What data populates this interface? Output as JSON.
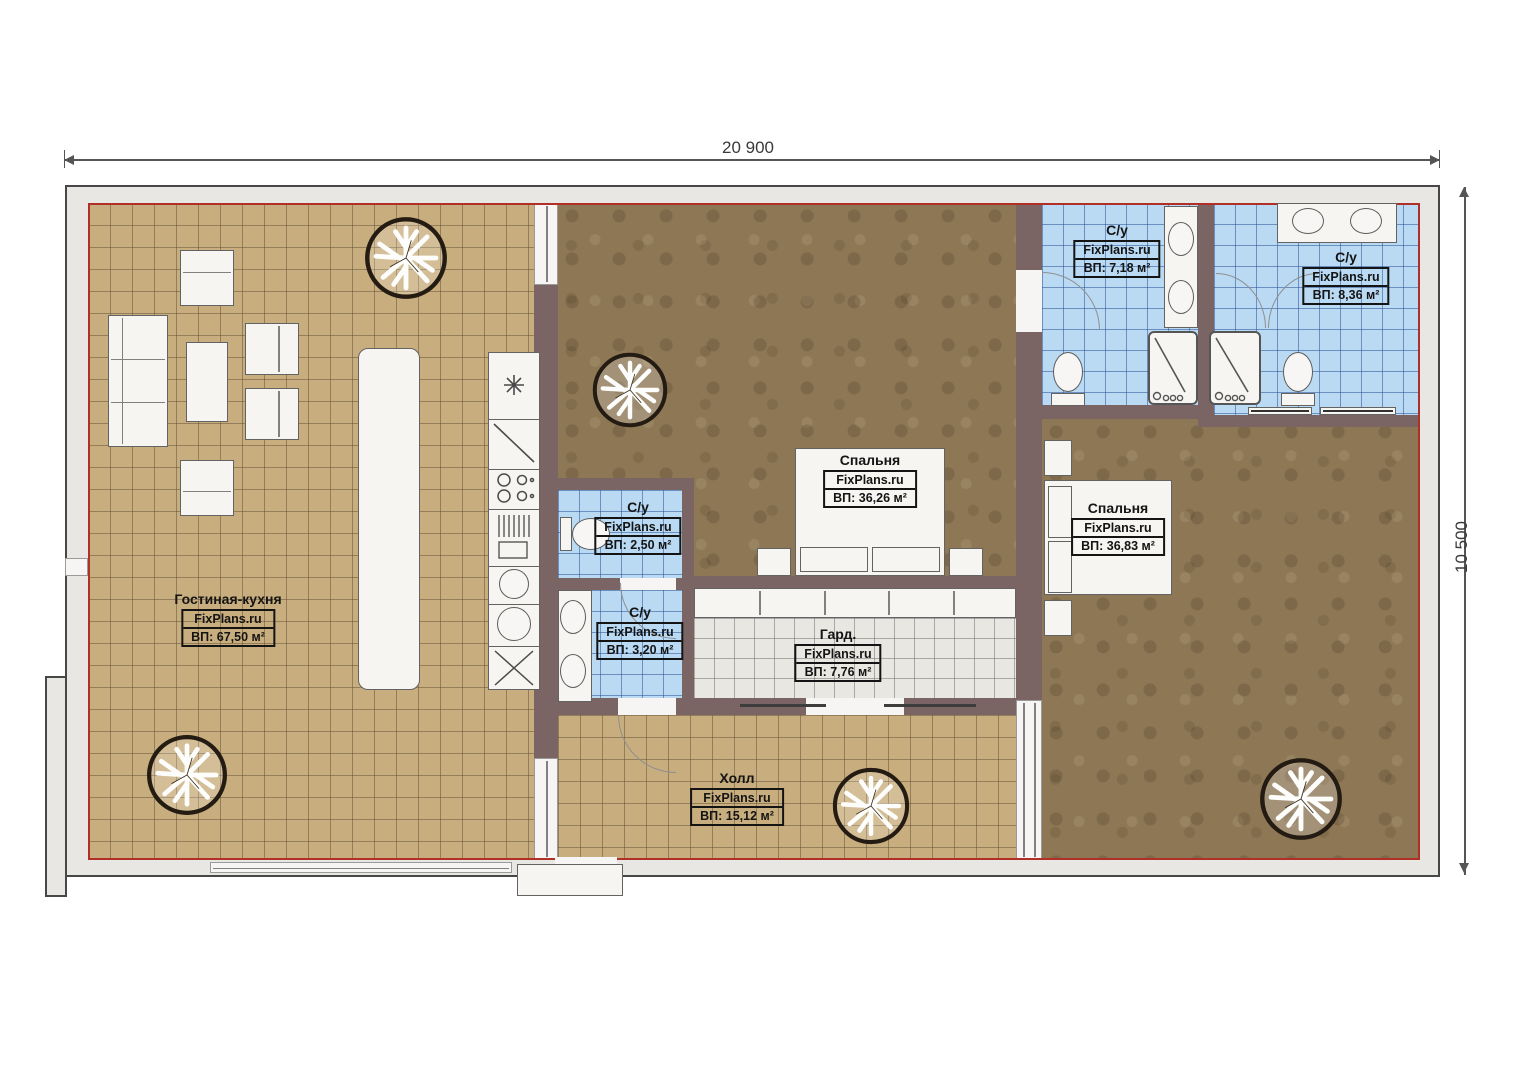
{
  "plan": {
    "site_watermark": "FixPlans.ru",
    "dimensions": {
      "width": "20 900",
      "height": "10 500"
    },
    "rooms": [
      {
        "id": "living-kitchen",
        "name": "Гостиная-кухня",
        "vendor": "FixPlans.ru",
        "area": "ВП: 67,50 м²"
      },
      {
        "id": "bath-top-left",
        "name": "С/у",
        "vendor": "FixPlans.ru",
        "area": "ВП: 7,18 м²"
      },
      {
        "id": "bath-top-right",
        "name": "С/у",
        "vendor": "FixPlans.ru",
        "area": "ВП: 8,36 м²"
      },
      {
        "id": "bedroom-1",
        "name": "Спальня",
        "vendor": "FixPlans.ru",
        "area": "ВП: 36,26 м²"
      },
      {
        "id": "bedroom-2",
        "name": "Спальня",
        "vendor": "FixPlans.ru",
        "area": "ВП: 36,83 м²"
      },
      {
        "id": "bath-small-1",
        "name": "С/у",
        "vendor": "FixPlans.ru",
        "area": "ВП: 2,50 м²"
      },
      {
        "id": "bath-small-2",
        "name": "С/у",
        "vendor": "FixPlans.ru",
        "area": "ВП: 3,20 м²"
      },
      {
        "id": "wardrobe",
        "name": "Гард.",
        "vendor": "FixPlans.ru",
        "area": "ВП: 7,76 м²"
      },
      {
        "id": "hall",
        "name": "Холл",
        "vendor": "FixPlans.ru",
        "area": "ВП: 15,12 м²"
      }
    ],
    "colors": {
      "accent_red": "#b03028",
      "wall": "#7b6464",
      "tile_beige": "#c8ae7e",
      "tile_blue": "#badaf4",
      "floor_brown": "#8d7755",
      "exterior_band": "#e9e7e3"
    }
  }
}
